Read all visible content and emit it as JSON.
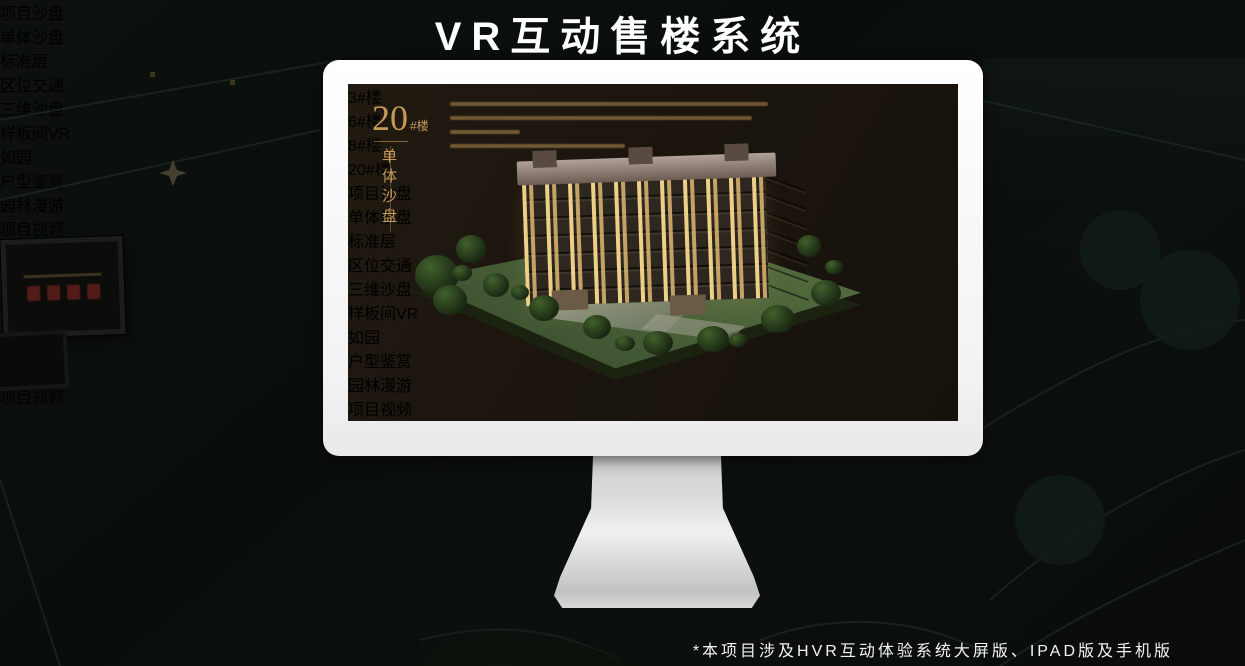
{
  "page": {
    "title": "VR互动售楼系统",
    "footnote": "*本项目涉及HVR互动体验系统大屏版、IPAD版及手机版"
  },
  "app_nav": {
    "logo": "如园",
    "items": [
      {
        "label": "区位交通"
      },
      {
        "label": "三维沙盘"
      },
      {
        "label": "样板间VR"
      },
      {
        "label": "户型鉴赏"
      },
      {
        "label": "园林漫游"
      },
      {
        "label": "项目视频"
      }
    ]
  },
  "monitor": {
    "heading": {
      "number": "20",
      "unit": "#楼",
      "subtitle": "单体沙盘"
    },
    "building_buttons": [
      {
        "label": "3#楼",
        "active": false
      },
      {
        "label": "6#楼",
        "active": false
      },
      {
        "label": "8#楼",
        "active": false
      },
      {
        "label": "20#楼",
        "active": true
      }
    ],
    "sub_tabs": [
      {
        "label": "项目沙盘",
        "active": false
      },
      {
        "label": "单体沙盘",
        "active": true
      },
      {
        "label": "标准层",
        "active": false
      }
    ],
    "active_nav": "三维沙盘"
  },
  "tablet": {
    "sub_tabs": [
      {
        "label": "项目沙盘",
        "active": true
      },
      {
        "label": "单体沙盘",
        "active": false
      },
      {
        "label": "标准层",
        "active": false
      }
    ],
    "active_nav": "三维沙盘"
  },
  "phone": {
    "active_nav": "园林漫游"
  },
  "colors": {
    "gold": "#d9b56a",
    "gold_dim": "#8f7340",
    "screen_bg": "#1b150e",
    "heading_gold": "#c59a57"
  }
}
